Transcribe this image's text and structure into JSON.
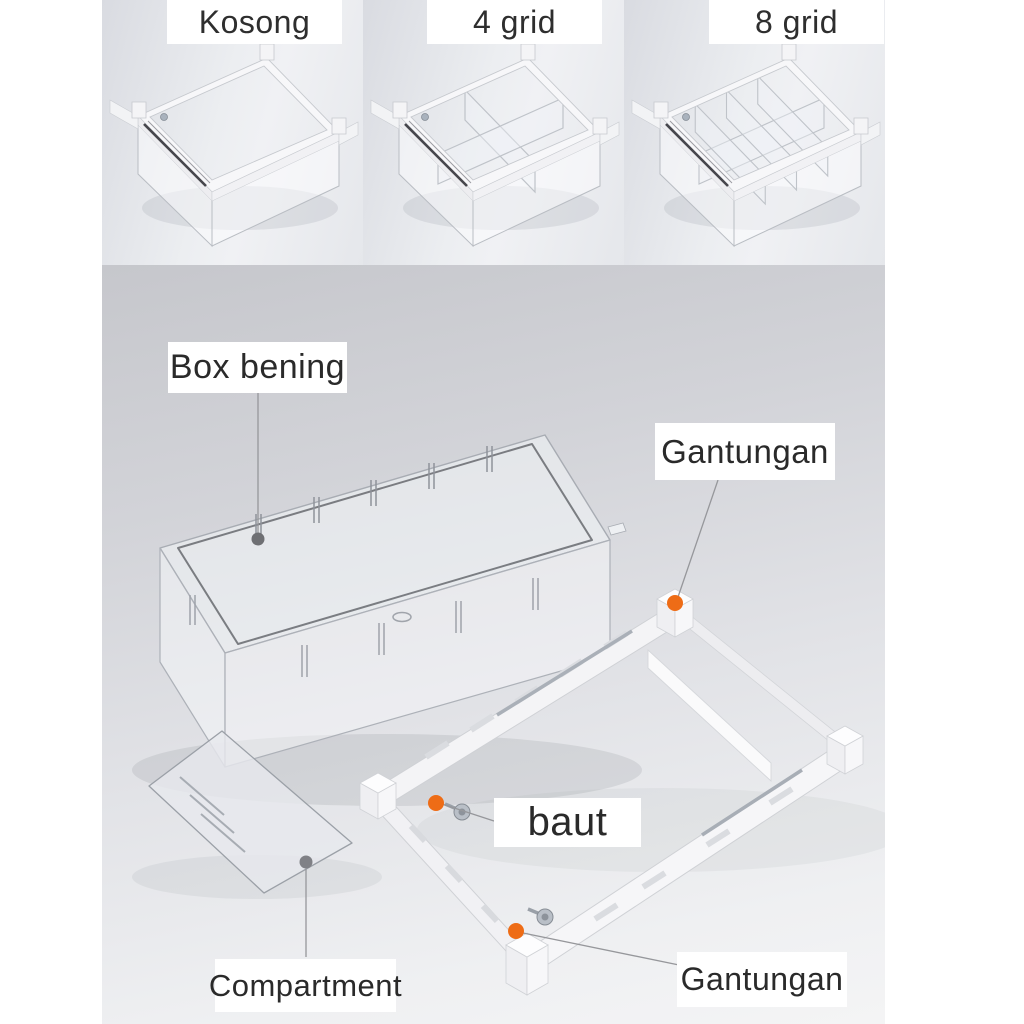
{
  "top_row": {
    "items": [
      {
        "label": "Kosong",
        "variant": "empty"
      },
      {
        "label": "4 grid",
        "variant": "4-grid"
      },
      {
        "label": "8 grid",
        "variant": "8-grid"
      }
    ]
  },
  "diagram": {
    "labels": {
      "box_bening": "Box bening",
      "gantungan_top": "Gantungan",
      "baut": "baut",
      "compartment": "Compartment",
      "gantungan_bottom": "Gantungan"
    },
    "colors": {
      "marker_orange": "#ee6c16",
      "marker_grey": "#6e6f73",
      "leader_line": "#96979b",
      "label_background": "#ffffff",
      "label_text": "#2a2a2a"
    }
  }
}
